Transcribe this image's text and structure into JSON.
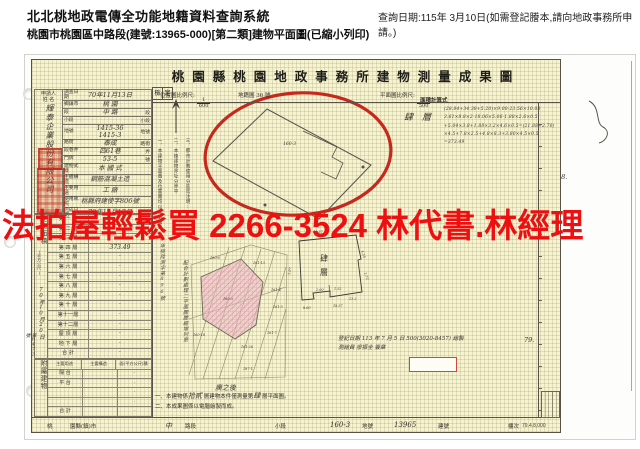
{
  "app": {
    "title": "北北桃地政電傳全功能地籍資料查詢系統",
    "query_note": "查詢日期:115年 3月10日(如需登記謄本,請向地政事務所申請。)",
    "subtitle": "桃園市桃園區中路段(建號:13965-000)[第二類]建物平面圖(已縮小列印)"
  },
  "watermark": {
    "text": "法拍屋輕鬆買  2266-3524  林代書.林經理",
    "color": "#ee1010"
  },
  "doc": {
    "title": "桃園縣桃園地政事務所建物測量成果圖",
    "scales": {
      "location_label": "位置圖比例尺:",
      "location_num": "1",
      "location_den": "600",
      "cadastral_note": "地籍圖 36 號",
      "plan_label": "平面圖比例尺:",
      "plan_num": "1",
      "plan_den": "500",
      "calc_label": "面積計算式",
      "check_1": "檢",
      "check_2": "定"
    },
    "calc": {
      "floor_label": "肆層",
      "lines": [
        "(28.84+34.38+5.20)×9.00-23.56×10.08",
        "3.61×8.8×2-18.06×5.06-1.88×2.6×0.5",
        "+5.04×3.8+1.88×3.2×4.6×0.5=(21.88+2.70)",
        "×4.5+7.8×2.5+4.8×8.3+3.80×4.5×0.5",
        "=373.49"
      ]
    },
    "applicant": {
      "header_1": "申請人",
      "header_2": "姓 名",
      "name": "輝泰企業股份有限公司"
    },
    "info_rows": [
      {
        "label": "調查日期",
        "value": "70年11月13日",
        "unit": ""
      },
      {
        "label": "鄉鎮市",
        "value": "桃 園",
        "unit": ""
      },
      {
        "label": "段",
        "value": "中 路",
        "unit": "段"
      },
      {
        "label": "小段",
        "value": "",
        "unit": "小段"
      },
      {
        "label": "地號",
        "value": "1415-36\n1415-3",
        "unit": "地號"
      },
      {
        "label": "路街",
        "value": "泰成",
        "unit": "路街"
      },
      {
        "label": "段巷弄",
        "value": "四61巷",
        "unit": "弄"
      },
      {
        "label": "門牌",
        "value": "53-5",
        "unit": "號"
      },
      {
        "label": "建物式樣",
        "value": "本 國 式",
        "unit": ""
      },
      {
        "label": "主體構造",
        "value": "鋼筋混凝土造",
        "unit": ""
      },
      {
        "label": "主要用途",
        "value": "工 廠",
        "unit": ""
      },
      {
        "label": "使用執照",
        "value": "桃縣府建使字806號",
        "unit": ""
      },
      {
        "label": "完成日期",
        "value": "70年11月17日",
        "unit": ""
      }
    ],
    "area_table": {
      "side_label": "建物面積",
      "side_sublabel": "(平方公尺)",
      "received_1": "70年10月20日",
      "received_2": "第6473號",
      "rows": [
        {
          "floor": "第 一 層",
          "area": ""
        },
        {
          "floor": "第 二 層",
          "area": ""
        },
        {
          "floor": "第 三 層",
          "area": ""
        },
        {
          "floor": "第 四 層",
          "area": "373.49"
        },
        {
          "floor": "第 五 層",
          "area": "·"
        },
        {
          "floor": "第 六 層",
          "area": "·"
        },
        {
          "floor": "第 七 層",
          "area": "·"
        },
        {
          "floor": "第 八 層",
          "area": "·"
        },
        {
          "floor": "第 九 層",
          "area": "·"
        },
        {
          "floor": "第 十 層",
          "area": "·"
        },
        {
          "floor": "第十一層",
          "area": "·"
        },
        {
          "floor": "第十二層",
          "area": "·"
        },
        {
          "floor": "屋 頂 層",
          "area": "·"
        },
        {
          "floor": "地 下 層",
          "area": "·"
        },
        {
          "floor": "合  計",
          "area": "·"
        }
      ]
    },
    "annex_table": {
      "side_label": "附屬建物",
      "headers": [
        "主要用途",
        "主要構造",
        "面(平方公尺)積"
      ],
      "rows": [
        {
          "use": "陽 台",
          "structure": "",
          "area": "·"
        },
        {
          "use": "平 台",
          "structure": "",
          "area": "·"
        },
        {
          "use": "",
          "structure": "",
          "area": "·"
        },
        {
          "use": "",
          "structure": "",
          "area": "·"
        },
        {
          "use": "合 計",
          "structure": "",
          "area": "·"
        }
      ]
    },
    "bottom_row": {
      "cells": [
        "桃",
        "園縣(鎮)市",
        "中",
        "路段",
        "小段",
        "160-3",
        "地號",
        "13965",
        "建號",
        "樓次"
      ],
      "print_code": "79.4.8,000"
    },
    "notes_vertical": [
      "一、本建物平面圖及位置圖均以電腦繪製",
      "二、本棟建物界址分界平",
      "三、都市計劃使用分區迄注明:"
    ],
    "notes_hand": [
      "70年桃陞測字第896號",
      "配合計劃處理二平面圖謄繪增列章"
    ],
    "bottom_notes": {
      "n1_a": "一、本建物係",
      "n1_h1": "拾貳",
      "n1_b": "層建物本件僅測量第",
      "n1_h2": "肆",
      "n1_c": "層平面圖。",
      "n2": "二、本成果圖係以電腦繪製而成。"
    },
    "survey_note": {
      "line1": "登記日期 113 年 7 月 5 日 500(3020-8457) 繪製",
      "line2": "測繪員 廖振全 簽章"
    },
    "margin_marks": {
      "m78": "78.",
      "m79": "79."
    }
  },
  "map": {
    "circle_lot": "160-3",
    "lots": [
      {
        "x": 57,
        "y": 172,
        "t": "160-6"
      },
      {
        "x": 100,
        "y": 177,
        "t": "161-13"
      },
      {
        "x": 118,
        "y": 204,
        "t": "161-4"
      },
      {
        "x": 120,
        "y": 221,
        "t": "161-5"
      },
      {
        "x": 40,
        "y": 249,
        "t": "160-18"
      },
      {
        "x": 88,
        "y": 261,
        "t": "161-26"
      },
      {
        "x": 114,
        "y": 247,
        "t": "161-7"
      },
      {
        "x": 90,
        "y": 283,
        "t": "187-1"
      },
      {
        "x": 70,
        "y": 213,
        "t": "160-3"
      }
    ],
    "sketch_caption": "廣之後",
    "floorplan": {
      "label_1": "肆",
      "label_2": "層",
      "dims": [
        {
          "x": 160,
          "y": 146,
          "t": "41.37"
        },
        {
          "x": 137,
          "y": 188,
          "t": "5.97",
          "r": -78
        },
        {
          "x": 150,
          "y": 222,
          "t": "8.60"
        },
        {
          "x": 180,
          "y": 220,
          "t": "18.37"
        },
        {
          "x": 196,
          "y": 213,
          "t": "13.2"
        },
        {
          "x": 208,
          "y": 164,
          "t": "4.35",
          "r": 70
        },
        {
          "x": 211,
          "y": 186,
          "t": "2.72",
          "r": 70
        },
        {
          "x": 181,
          "y": 203,
          "t": "1.52"
        },
        {
          "x": 163,
          "y": 204,
          "t": "2.00"
        }
      ]
    },
    "colors": {
      "annotation_red": "#c5281c",
      "hatch_pink": "#d98ba2",
      "paper": "#f6f3d2"
    }
  }
}
